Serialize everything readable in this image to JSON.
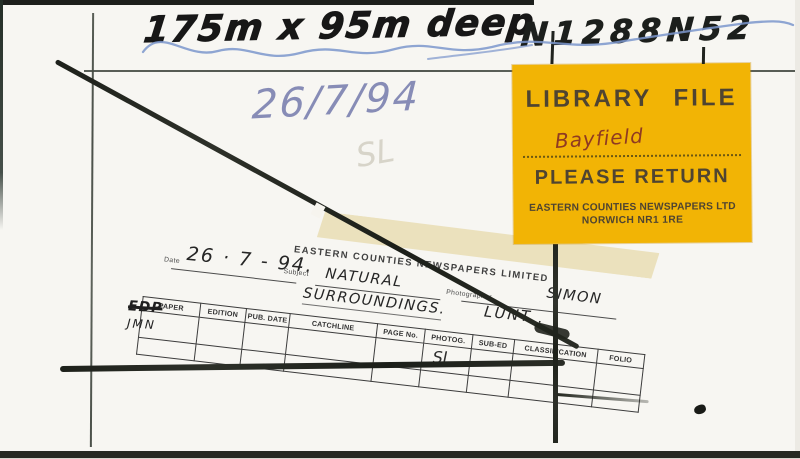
{
  "annotations": {
    "dimensions": "175m x 95m deep",
    "reference": "N1288N52",
    "date_scribble": "26/7/94",
    "initials_scribble": "SL"
  },
  "sticker": {
    "title": "LIBRARY FILE",
    "file_name": "Bayfield",
    "instruction": "PLEASE RETURN",
    "company": "EASTERN COUNTIES NEWSPAPERS LTD",
    "address": "NORWICH NR1 1RE",
    "colors": {
      "background": "#f2b405",
      "text": "#4f4431",
      "handwriting": "#8f3a22"
    }
  },
  "stamp": {
    "company": "EASTERN COUNTIES NEWSPAPERS LIMITED",
    "date_label": "Date",
    "date_value": "26 · 7 - 94.",
    "subject_label": "Subject",
    "subject_line1": "NATURAL",
    "subject_line2": "SURROUNDINGS.",
    "photographer_label": "Photographer",
    "photographer_line1": "SIMON",
    "photographer_line2": "LUNT .",
    "table": {
      "headers": [
        "PAPER",
        "EDITION",
        "PUB. DATE",
        "CATCHLINE",
        "PAGE No.",
        "PHOTOG.",
        "SUB-ED",
        "CLASSIFICATION",
        "FOLIO"
      ],
      "paper_entry_crossed": "EDP",
      "paper_entry": "JMN",
      "photog_entry": "SL"
    }
  },
  "colors": {
    "paper": "#f7f6f2",
    "marker_ink": "#171717",
    "pen_blue": "#7b96cc",
    "ballpoint_blue": "#878cb6",
    "stamp_ink": "#3d3d3d",
    "charcoal": "#23261f",
    "pencil": "#454b43"
  }
}
